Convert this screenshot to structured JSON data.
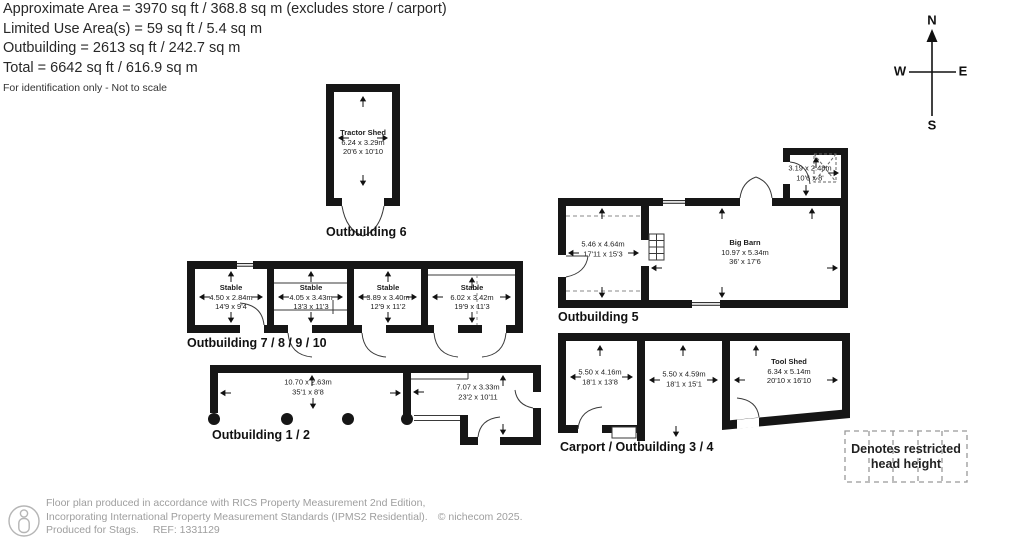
{
  "header": {
    "approximate_area": "Approximate Area = 3970 sq ft / 368.8 sq m (excludes store / carport)",
    "limited_use": "Limited Use Area(s) = 59 sq ft / 5.4 sq m",
    "outbuilding": "Outbuilding = 2613 sq ft / 242.7 sq m",
    "total": "Total = 6642 sq ft / 616.9 sq m",
    "disclaimer": "For identification only - Not to scale"
  },
  "compass": {
    "north": "N",
    "east": "E",
    "south": "S",
    "west": "W"
  },
  "buildings": {
    "outbuilding6": {
      "label": "Outbuilding 6",
      "tractor_shed": {
        "name": "Tractor Shed",
        "dim_m": "6.24 x 3.29m",
        "dim_ft": "20'6 x 10'10"
      }
    },
    "outbuilding7_10": {
      "label": "Outbuilding 7 / 8 / 9 / 10",
      "stable1": {
        "name": "Stable",
        "dim_m": "4.50 x 2.84m",
        "dim_ft": "14'9 x 9'4"
      },
      "stable2": {
        "name": "Stable",
        "dim_m": "4.05 x 3.43m",
        "dim_ft": "13'3 x 11'3"
      },
      "stable3": {
        "name": "Stable",
        "dim_m": "3.89 x 3.40m",
        "dim_ft": "12'9 x 11'2"
      },
      "stable4": {
        "name": "Stable",
        "dim_m": "6.02 x 3.42m",
        "dim_ft": "19'9 x 11'3"
      }
    },
    "outbuilding5": {
      "label": "Outbuilding 5",
      "left_room": {
        "dim_m": "5.46 x 4.64m",
        "dim_ft": "17'11 x 15'3"
      },
      "big_barn": {
        "name": "Big Barn",
        "dim_m": "10.97 x 5.34m",
        "dim_ft": "36' x 17'6"
      },
      "store": {
        "dim_m": "3.19 x 2.48m",
        "dim_ft": "10'6 x 8'"
      }
    },
    "outbuilding1_2": {
      "label": "Outbuilding 1 / 2",
      "open_bay": {
        "dim_m": "10.70 x 2.63m",
        "dim_ft": "35'1 x 8'8"
      },
      "room": {
        "dim_m": "7.07 x 3.33m",
        "dim_ft": "23'2 x 10'11"
      }
    },
    "carport3_4": {
      "label": "Carport / Outbuilding 3 / 4",
      "room1": {
        "dim_m": "5.50 x 4.16m",
        "dim_ft": "18'1 x 13'8"
      },
      "carport": {
        "dim_m": "5.50 x 4.59m",
        "dim_ft": "18'1 x 15'1"
      },
      "tool_shed": {
        "name": "Tool Shed",
        "dim_m": "6.34 x 5.14m",
        "dim_ft": "20'10 x 16'10"
      }
    }
  },
  "legend": {
    "restricted_line1": "Denotes restricted",
    "restricted_line2": "head height"
  },
  "footer": {
    "line1": "Floor plan produced in accordance with RICS Property Measurement 2nd Edition,",
    "line2": "Incorporating International Property Measurement Standards (IPMS2 Residential).",
    "copyright": "© nichecom 2025.",
    "produced_for": "Produced for Stags.",
    "ref": "REF: 1331129"
  },
  "colors": {
    "wall": "#161616",
    "line": "#3a3a3a",
    "text": "#222222",
    "footer_text": "#9e9e9e"
  }
}
